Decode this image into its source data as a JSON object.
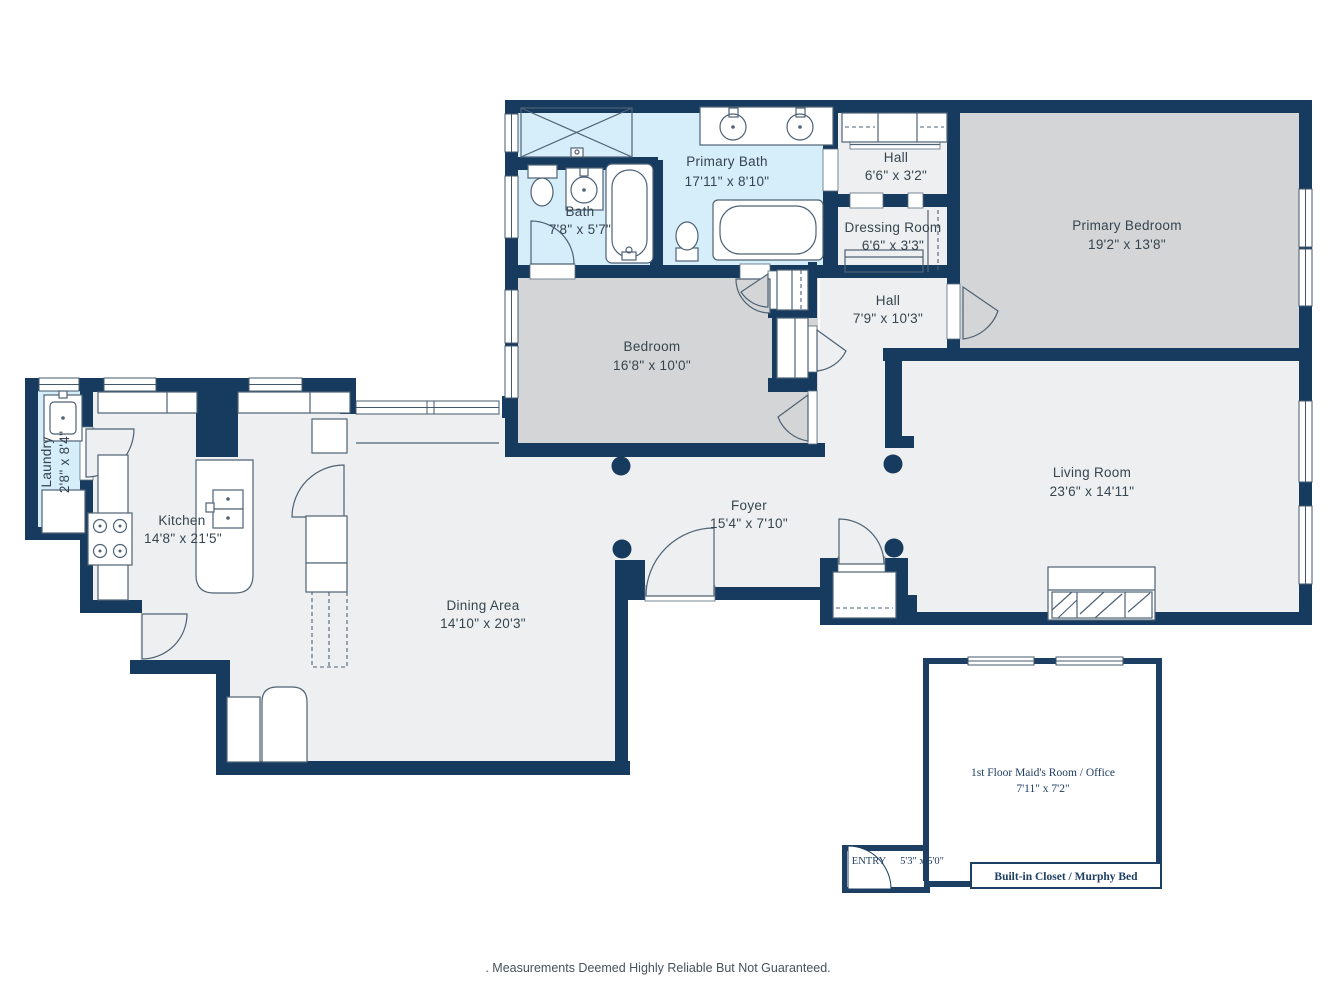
{
  "rooms": {
    "primary_bath": {
      "name": "Primary Bath",
      "dims": "17'11\" x 8'10\""
    },
    "hall_top": {
      "name": "Hall",
      "dims": "6'6\" x 3'2\""
    },
    "bath": {
      "name": "Bath",
      "dims": "7'8\" x 5'7\""
    },
    "dressing_room": {
      "name": "Dressing Room",
      "dims": "6'6\" x 3'3\""
    },
    "primary_bedroom": {
      "name": "Primary Bedroom",
      "dims": "19'2\" x 13'8\""
    },
    "bedroom": {
      "name": "Bedroom",
      "dims": "16'8\" x 10'0\""
    },
    "hall": {
      "name": "Hall",
      "dims": "7'9\" x 10'3\""
    },
    "living_room": {
      "name": "Living Room",
      "dims": "23'6\" x 14'11\""
    },
    "foyer": {
      "name": "Foyer",
      "dims": "15'4\" x 7'10\""
    },
    "kitchen": {
      "name": "Kitchen",
      "dims": "14'8\" x 21'5\""
    },
    "laundry": {
      "name": "Laundry",
      "dims": "2'8\" x 8'4\""
    },
    "dining_area": {
      "name": "Dining Area",
      "dims": "14'10\" x 20'3\""
    },
    "maids_room": {
      "name": "1st Floor Maid's Room / Office",
      "dims": "7'11\" x 7'2\""
    },
    "entry": {
      "name": "ENTRY",
      "dims": "5'3\" x 5'0\""
    },
    "built_in_closet": {
      "label": "Built-in Closet / Murphy Bed"
    }
  },
  "footer": {
    "disclaimer": ". Measurements Deemed Highly Reliable But Not Guaranteed."
  },
  "colors": {
    "wall": "#173b5e",
    "floor": "#edeff0",
    "bedroom_floor": "#d4d5d6",
    "bath_floor": "#d6edfa",
    "fixture_line": "#4e6275",
    "label_text": "#36454f"
  }
}
